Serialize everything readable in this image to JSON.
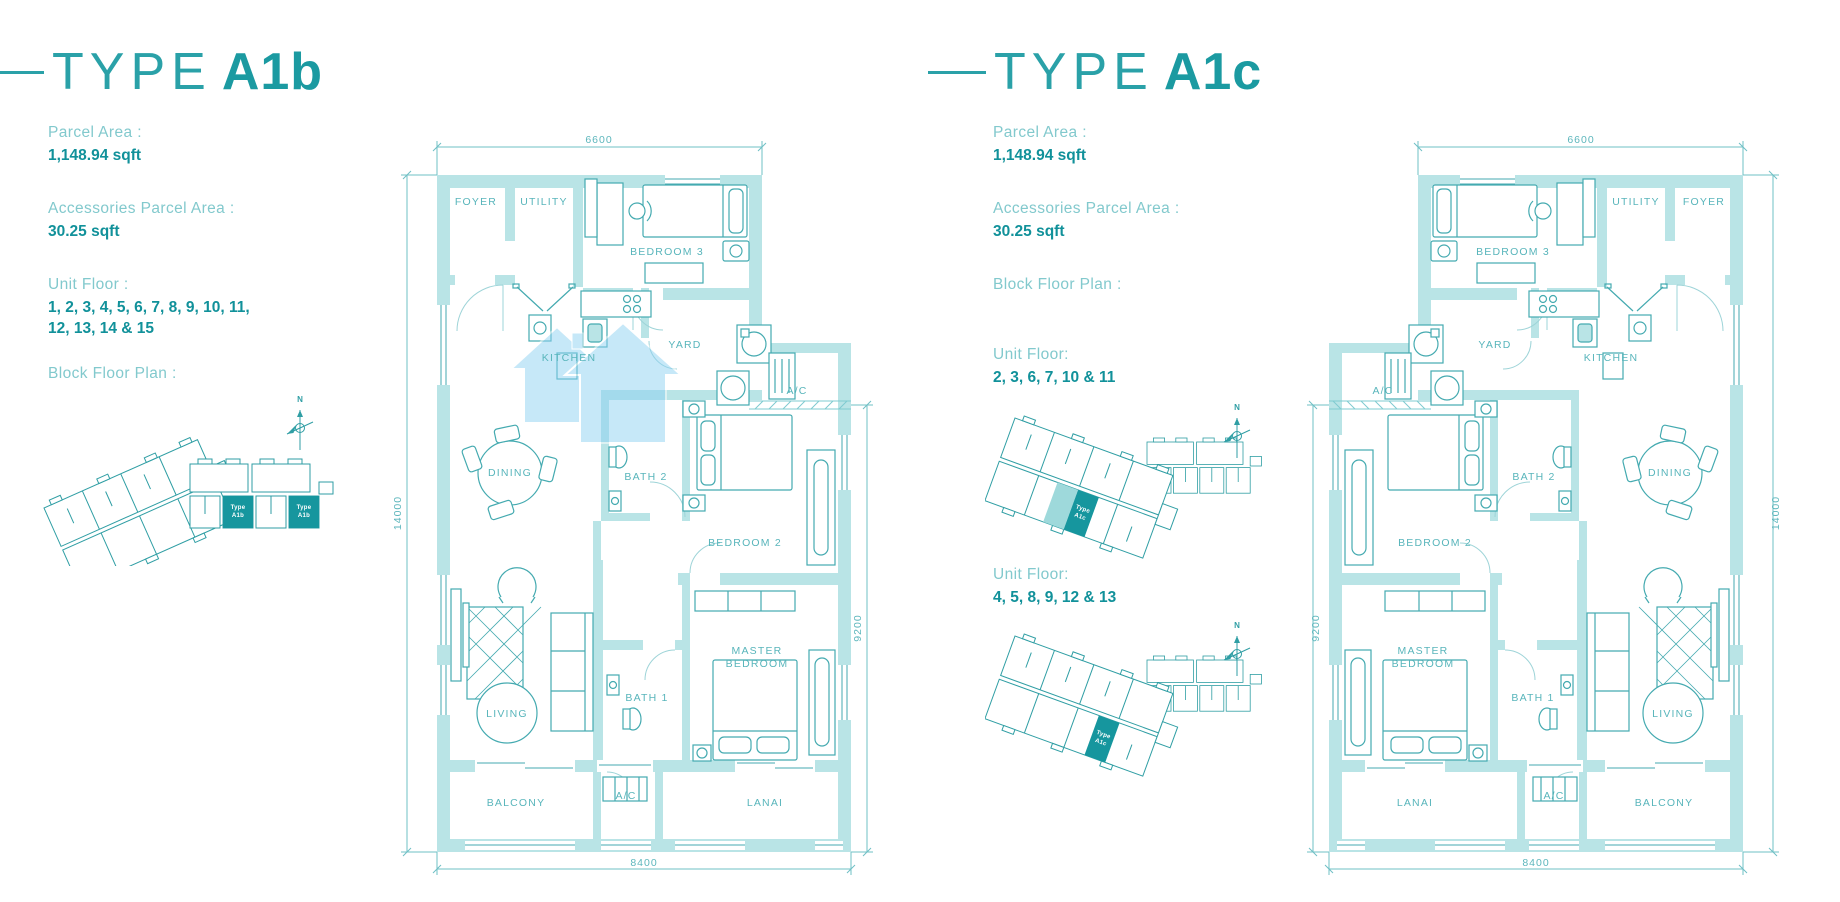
{
  "colors": {
    "accent_teal": "#2aa1a8",
    "bold_teal": "#11919a",
    "soft_label_teal": "#82c9cd",
    "wall_fill": "#b9e4e6",
    "line_teal": "#44aab0",
    "highlight_unit": "#16969e",
    "watermark_blue": "#8fd2f3"
  },
  "left_panel": {
    "title_prefix": "TYPE",
    "title_bold": "A1b",
    "parcel_area_label": "Parcel Area :",
    "parcel_area_value": "1,148.94 sqft",
    "accessories_label": "Accessories Parcel Area :",
    "accessories_value": "30.25 sqft",
    "unit_floor_label": "Unit Floor :",
    "unit_floor_line1": "1, 2, 3, 4, 5, 6, 7, 8, 9, 10, 11,",
    "unit_floor_line2": "12, 13, 14 & 15",
    "block_plan_label": "Block Floor Plan :",
    "site_map": {
      "compass_label": "N",
      "tag_line1": "Type",
      "tag_line2": "A1b"
    },
    "plan": {
      "dim_top": "6600",
      "dim_left": "14000",
      "dim_right": "9200",
      "dim_bottom": "8400",
      "rooms": {
        "foyer": "FOYER",
        "utility": "UTILITY",
        "bedroom3": "BEDROOM 3",
        "kitchen": "KITCHEN",
        "yard": "YARD",
        "ac_top": "A/C",
        "dining": "DINING",
        "bath2": "BATH 2",
        "bedroom2": "BEDROOM 2",
        "master1": "MASTER",
        "master2": "BEDROOM",
        "bath1": "BATH 1",
        "living": "LIVING",
        "balcony": "BALCONY",
        "ac_bottom": "A/C",
        "lanai": "LANAI"
      }
    }
  },
  "right_panel": {
    "title_prefix": "TYPE",
    "title_bold": "A1c",
    "parcel_area_label": "Parcel Area :",
    "parcel_area_value": "1,148.94 sqft",
    "accessories_label": "Accessories Parcel Area :",
    "accessories_value": "30.25 sqft",
    "block_plan_label": "Block Floor Plan :",
    "unit_floors_1": {
      "label": "Unit Floor:",
      "value": "2, 3, 6, 7, 10 & 11"
    },
    "unit_floors_2": {
      "label": "Unit Floor:",
      "value": "4, 5, 8, 9, 12 & 13"
    },
    "site_map": {
      "compass_label": "N",
      "tag_line1": "Type",
      "tag_line2": "A1c"
    },
    "plan": {
      "dim_top": "6600",
      "dim_left": "9200",
      "dim_right": "14000",
      "dim_bottom": "8400",
      "rooms": {
        "foyer": "FOYER",
        "utility": "UTILITY",
        "bedroom3": "BEDROOM 3",
        "kitchen": "KITCHEN",
        "yard": "YARD",
        "ac_top": "A/C",
        "dining": "DINING",
        "bath2": "BATH 2",
        "bedroom2": "BEDROOM 2",
        "master1": "MASTER",
        "master2": "BEDROOM",
        "bath1": "BATH 1",
        "living": "LIVING",
        "balcony": "BALCONY",
        "ac_bottom": "A/C",
        "lanai": "LANAI"
      }
    }
  }
}
